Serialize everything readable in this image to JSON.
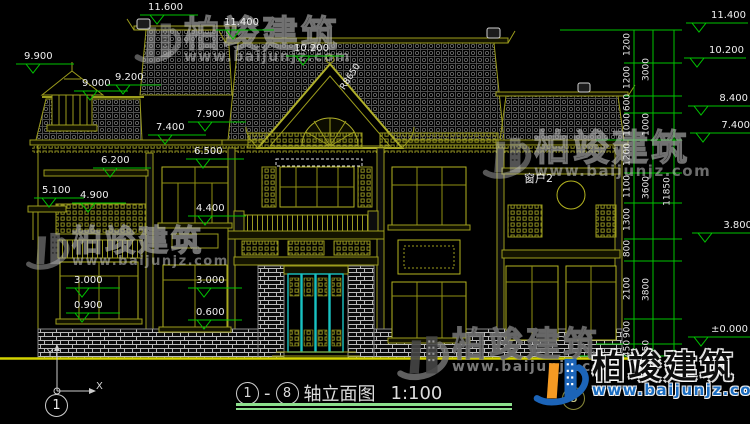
{
  "drawing_title": {
    "axis_start": "1",
    "separator": "-",
    "axis_end": "8",
    "name": "轴立面图",
    "scale": "1:100"
  },
  "axis_bubbles": {
    "left": "1",
    "right": "8"
  },
  "ucs": {
    "x_label": "X",
    "y_label": "Y"
  },
  "levels_left": [
    "11.600",
    "11.400",
    "10.200",
    "9.900",
    "9.000",
    "9.200",
    "7.900",
    "7.400",
    "6.500",
    "6.200",
    "5.100",
    "4.900",
    "4.400",
    "3.000",
    "0.900",
    "3.000",
    "0.600"
  ],
  "levels_right": [
    "11.400",
    "10.200",
    "8.400",
    "7.400",
    "3.800",
    "±0.000"
  ],
  "dims_col1": [
    "1200",
    "1200",
    "600",
    "1000",
    "1200",
    "1100",
    "1300",
    "800",
    "2100",
    "900",
    "450"
  ],
  "dims_col2": [
    "3000",
    "1000",
    "3600",
    "3800",
    "450"
  ],
  "dims_col3": [
    "11850"
  ],
  "annotations": {
    "window_label": "窗户2",
    "roof_radius": "R8650"
  },
  "watermark": {
    "brand": "柏竣建筑",
    "url": "www.baijunjz.com"
  },
  "colors": {
    "cad_line": "#9c9c1c",
    "dim_green": "#00c300",
    "door_teal": "#19c2c2",
    "ground_yellow": "#d2d200",
    "logo_blue": "#1c64b8",
    "logo_orange": "#f59a23"
  }
}
